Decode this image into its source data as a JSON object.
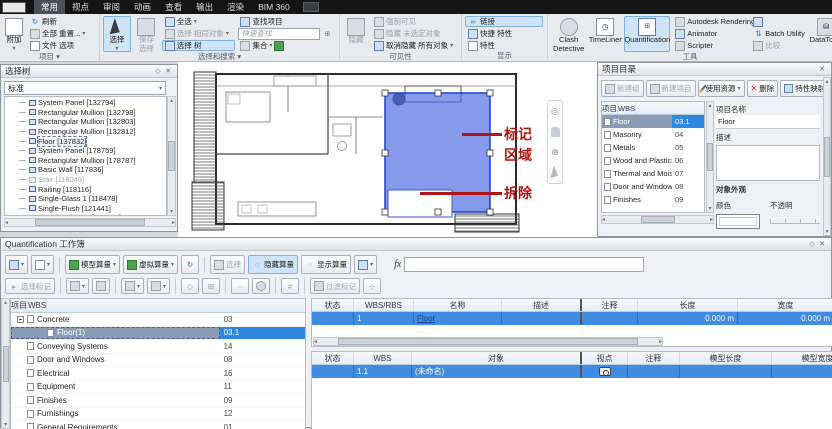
{
  "titlebar": {
    "tabs": [
      {
        "label": "常用",
        "cls": "active"
      },
      {
        "label": "视点"
      },
      {
        "label": "审阅"
      },
      {
        "label": "动画"
      },
      {
        "label": "查看"
      },
      {
        "label": "输出"
      },
      {
        "label": "渲染"
      },
      {
        "label": "BIM 360"
      }
    ]
  },
  "ribbon": {
    "project": {
      "append": "附加",
      "refresh": "刷新",
      "reset_all": "全部 重置...",
      "file_options": "文件 选项",
      "label": "项目"
    },
    "select_search": {
      "select": "选择",
      "save_selection": "保存 选择",
      "select_all": "全选",
      "select_same": "选择 相同对象",
      "selection_tree": "选择 树",
      "find_items": "查找项目",
      "quick_find_placeholder": "快速查找",
      "sets": "集合",
      "label": "选择和搜索"
    },
    "visibility": {
      "hide": "隐藏",
      "require": "强制可见",
      "hide_unselected": "隐藏 未选定对象",
      "unhide_all": "取消隐藏 所有对象",
      "label": "可见性"
    },
    "display": {
      "links": "链接",
      "quick_properties": "快捷 特性",
      "properties": "特性",
      "label": "显示"
    },
    "tools": {
      "clash": "Clash Detective",
      "timeliner": "TimeLiner",
      "quantification": "Quantification",
      "rendering": "Autodesk Rendering",
      "animator": "Animator",
      "scripter": "Scripter",
      "batch_utility": "Batch Utility",
      "compare": "比较",
      "datatools": "DataTools",
      "label": "工具"
    }
  },
  "selection_tree": {
    "title": "选择树",
    "mode": "标准",
    "items": [
      {
        "label": "System Panel [132794]"
      },
      {
        "label": "Rectangular Mullion [132798]"
      },
      {
        "label": "Rectangular Mullion [132803]"
      },
      {
        "label": "Rectangular Mullion [132812]"
      },
      {
        "label": "Floor [137832]",
        "cls": "selected"
      },
      {
        "label": "System Panel [178759]"
      },
      {
        "label": "Rectangular Mullion [178787]"
      },
      {
        "label": "Basic Wall [117836]"
      },
      {
        "label": "Stair [118049]",
        "cls": "disabled"
      },
      {
        "label": "Railing [118116]"
      },
      {
        "label": "Single-Glass 1 [118478]"
      },
      {
        "label": "Single-Flush [121441]"
      },
      {
        "label": "Double-Glass 1 [122179]"
      }
    ]
  },
  "canvas": {
    "annotations": {
      "mark_line1": "标记",
      "mark_line2": "区域",
      "demolish": "拆除"
    }
  },
  "item_catalog": {
    "title": "项目目录",
    "toolbar": {
      "new_group": "新建组",
      "new_item": "新建项目",
      "use_resource": "使用资源",
      "delete": "删除",
      "property_mapping": "特性映射"
    },
    "columns": [
      "项目",
      "WBS"
    ],
    "rows": [
      {
        "label": "Floor",
        "wbs": "03.1",
        "cls": "selected"
      },
      {
        "label": "Masonry",
        "wbs": "04"
      },
      {
        "label": "Metals",
        "wbs": "05"
      },
      {
        "label": "Wood and Plastics",
        "wbs": "06"
      },
      {
        "label": "Thermal and Mois...",
        "wbs": "07"
      },
      {
        "label": "Door and Windows",
        "wbs": "08"
      },
      {
        "label": "Finishes",
        "wbs": "09"
      }
    ],
    "form": {
      "name_label": "项目名称",
      "name_value": "Floor",
      "desc_label": "描述",
      "appearance_label": "对象外观",
      "color_label": "颜色",
      "opacity_label": "不透明"
    }
  },
  "workbook": {
    "title": "Quantification 工作簿",
    "toolbar": {
      "model_takeoff": "模型算量",
      "virtual_takeoff": "虚拟算量",
      "select": "选择",
      "hide_takeoff": "隐藏算量",
      "show_takeoff": "显示算量",
      "fx_label": "fx",
      "select_markup": "选择标记",
      "filter_markup": "过滤标记"
    },
    "tree": {
      "columns": [
        "项目",
        "WBS"
      ],
      "rows": [
        {
          "label": "Concrete",
          "wbs": "03",
          "cls": "parent"
        },
        {
          "label": "Floor(1)",
          "wbs": "03.1",
          "cls": "child selected"
        },
        {
          "label": "Conveying Systems",
          "wbs": "14"
        },
        {
          "label": "Door and Windows",
          "wbs": "08"
        },
        {
          "label": "Electrical",
          "wbs": "16"
        },
        {
          "label": "Equipment",
          "wbs": "11"
        },
        {
          "label": "Finishes",
          "wbs": "09"
        },
        {
          "label": "Furnishings",
          "wbs": "12"
        },
        {
          "label": "General Requirements",
          "wbs": "01"
        }
      ]
    },
    "upper_table": {
      "columns": [
        "状态",
        "WBS/RBS",
        "名称",
        "描述",
        "注释",
        "长度",
        "宽度"
      ],
      "row": {
        "status": "",
        "wbs": "1",
        "name": "Floor",
        "desc": "",
        "comment": "",
        "length": "0.000 m",
        "width": "0.000 m"
      }
    },
    "lower_table": {
      "columns": [
        "状态",
        "WBS",
        "对象",
        "视点",
        "注释",
        "模型长度",
        "模型宽度",
        "模型厚度"
      ],
      "row": {
        "status": "",
        "wbs": "1.1",
        "object": "(未命名)",
        "comment": ""
      }
    }
  }
}
